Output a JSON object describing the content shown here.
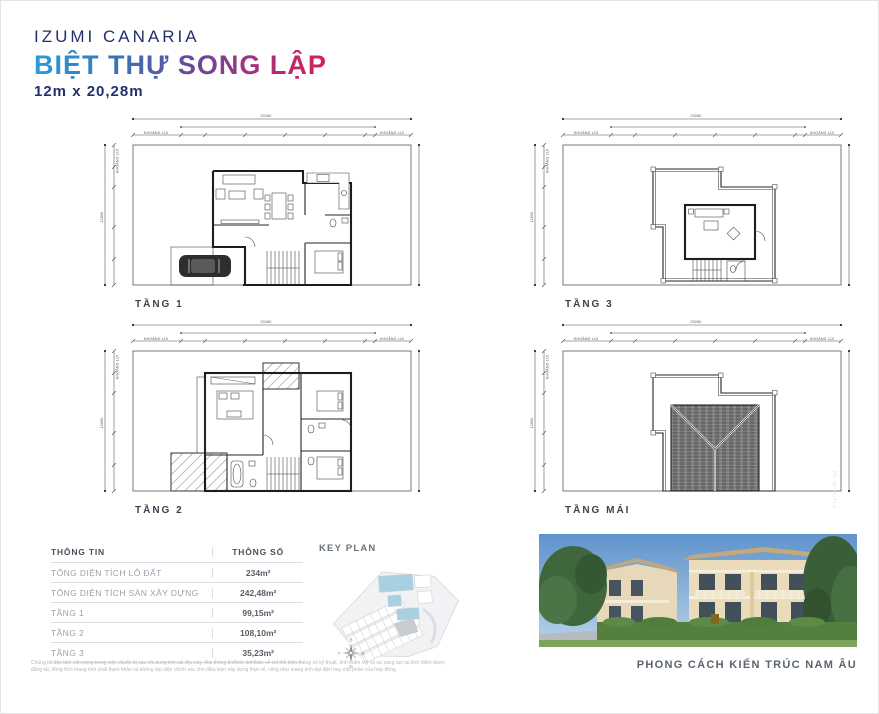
{
  "header": {
    "project": "IZUMI CANARIA",
    "title": "BIỆT THỰ SONG LẬP",
    "size": "12m x 20,28m",
    "accent_navy": "#242f6b",
    "title_gradient": [
      "#2b9cd8",
      "#6b4798",
      "#d81f54"
    ]
  },
  "plans": [
    {
      "id": "tang-1",
      "label": "TẦNG 1"
    },
    {
      "id": "tang-3",
      "label": "TẦNG 3"
    },
    {
      "id": "tang-2",
      "label": "TẦNG 2"
    },
    {
      "id": "tang-mai",
      "label": "TẦNG MÁI"
    }
  ],
  "dims": {
    "total_w": "20280",
    "total_h": "12000",
    "setback": "KHOẢNG LÙI"
  },
  "table": {
    "headers": [
      "THÔNG TIN",
      "THÔNG SỐ"
    ],
    "rows": [
      {
        "label": "TỔNG DIỆN TÍCH LÔ ĐẤT",
        "value": "234m²"
      },
      {
        "label": "TỔNG DIỆN TÍCH SÀN XÂY DỰNG",
        "value": "242,48m²"
      },
      {
        "label": "TẦNG 1",
        "value": "99,15m²"
      },
      {
        "label": "TẦNG 2",
        "value": "108,10m²"
      },
      {
        "label": "TẦNG 3",
        "value": "35,23m²"
      }
    ]
  },
  "key_plan": {
    "title": "KEY PLAN",
    "highlight_color": "#a9cfe2",
    "compass": {
      "n": "B",
      "e": "Đ",
      "s": "N",
      "w": "T"
    }
  },
  "photo": {
    "caption": "PHONG CÁCH KIẾN TRÚC NAM ÂU"
  },
  "disclaimer": {
    "line1": "Chúng tôi đặc biệt cẩn trọng trong việc chuẩn bị các nội dung trên tài liệu này. Mọi thông tin/hình ảnh/bản vẽ chỉ thể hiện thông số kỹ thuật, tính thẩm mỹ và sự sáng tạo tại thời điểm được",
    "line2": "đăng tải, đồng thời mang tính chất tham khảo và không đại diện chính xác cho điều kiện xây dựng thực tế, cũng như mang tính đại diện hay một phần của hợp đồng."
  },
  "watermark": {
    "code": "PK.SL04.TL3"
  }
}
